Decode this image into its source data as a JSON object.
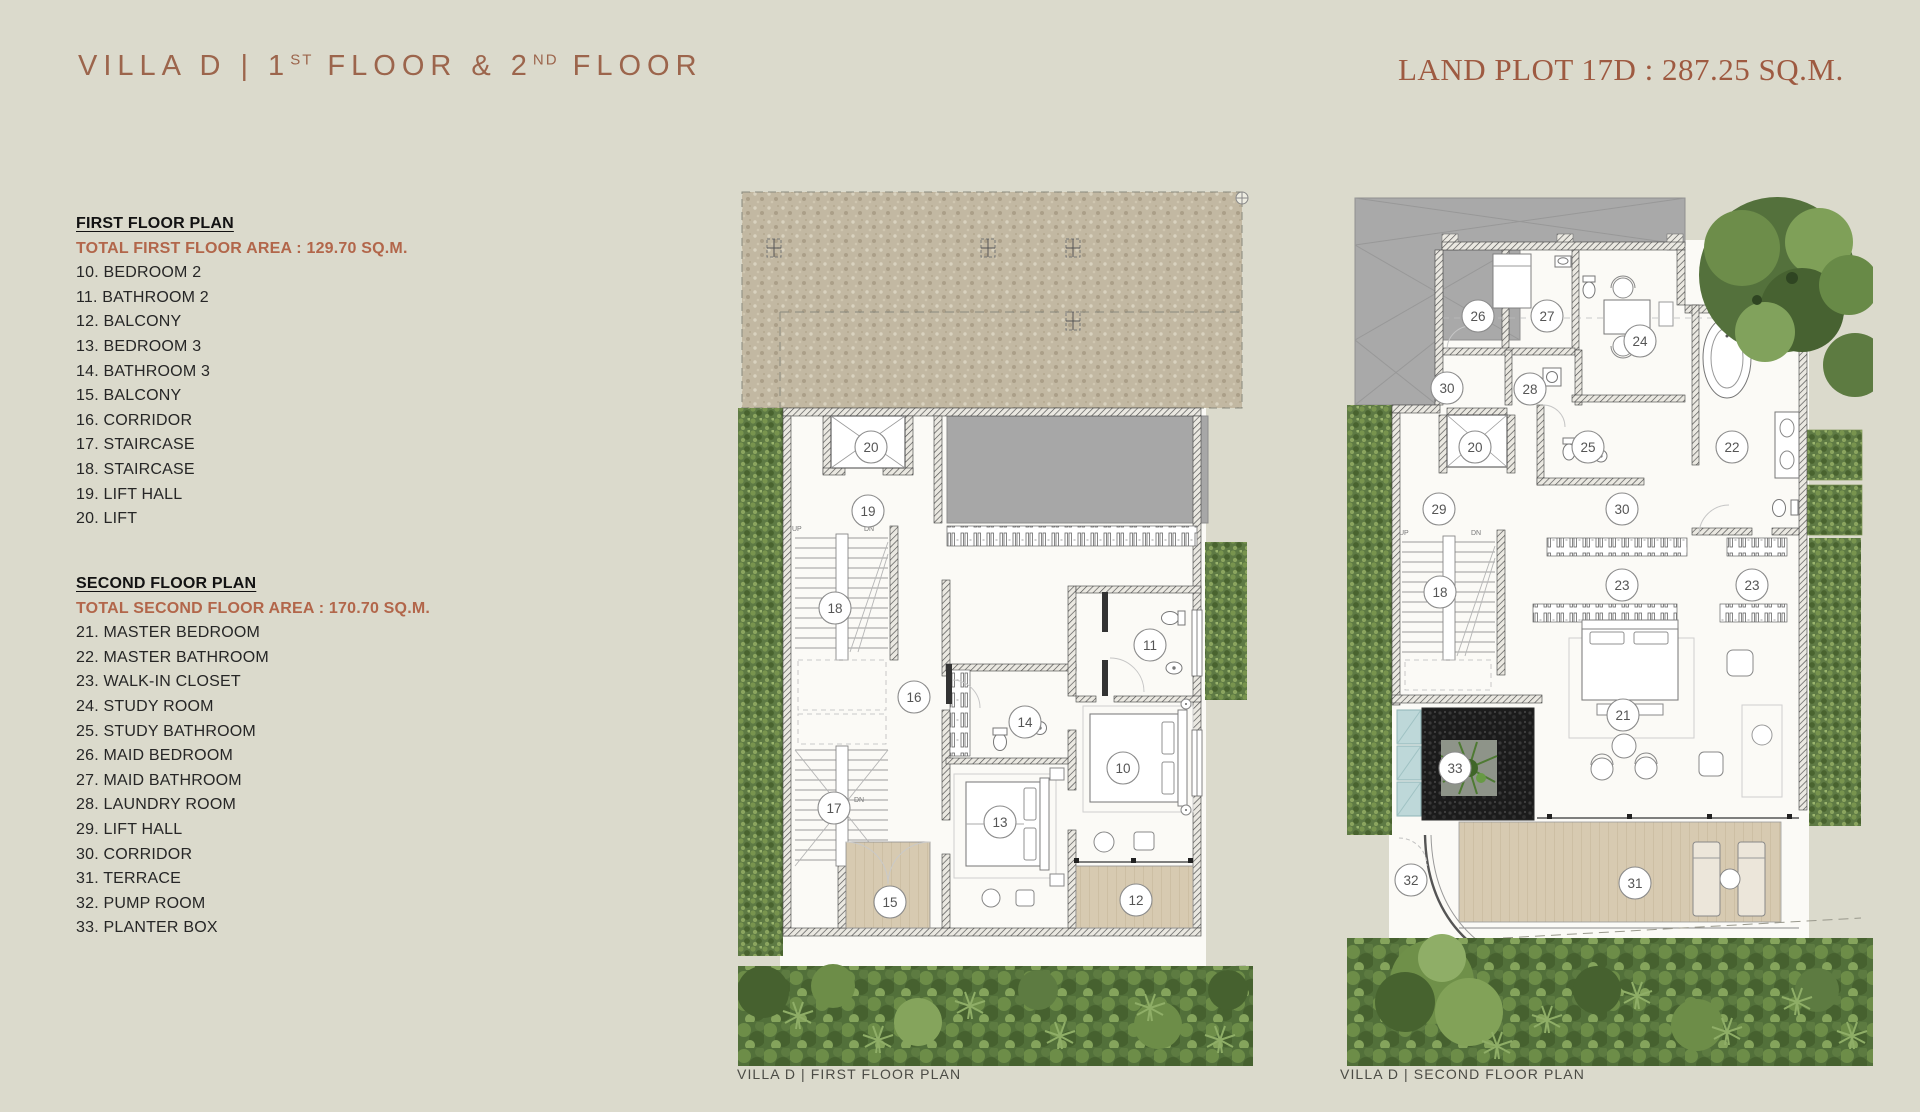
{
  "header": {
    "villa": {
      "p1": "VILLA D | 1",
      "sup1": "ST",
      "p2": " FLOOR & 2",
      "sup2": "ND",
      "p3": " FLOOR"
    },
    "land_plot": "LAND PLOT 17D : 287.25 SQ.M."
  },
  "legend_first": {
    "heading": "FIRST FLOOR PLAN",
    "area": "TOTAL FIRST FLOOR AREA : 129.70 SQ.M.",
    "items": [
      "10. BEDROOM 2",
      "11. BATHROOM 2",
      "12. BALCONY",
      "13. BEDROOM 3",
      "14. BATHROOM 3",
      "15. BALCONY",
      "16. CORRIDOR",
      "17. STAIRCASE",
      "18. STAIRCASE",
      "19. LIFT HALL",
      "20. LIFT"
    ]
  },
  "legend_second": {
    "heading": "SECOND FLOOR PLAN",
    "area": "TOTAL SECOND FLOOR AREA : 170.70 SQ.M.",
    "items": [
      "21. MASTER BEDROOM",
      "22. MASTER BATHROOM",
      "23. WALK-IN CLOSET",
      "24. STUDY ROOM",
      "25. STUDY BATHROOM",
      "26. MAID BEDROOM",
      "27. MAID BATHROOM",
      "28. LAUNDRY ROOM",
      "29. LIFT HALL",
      "30. CORRIDOR",
      "31. TERRACE",
      "32. PUMP ROOM",
      "33. PLANTER BOX"
    ]
  },
  "plans": {
    "first": {
      "caption": "VILLA D | FIRST FLOOR PLAN",
      "labels": [
        "20",
        "19",
        "18",
        "16",
        "17",
        "14",
        "13",
        "15",
        "11",
        "10",
        "12"
      ]
    },
    "second": {
      "caption": "VILLA D | SECOND FLOOR PLAN",
      "labels": [
        "26",
        "27",
        "24",
        "30",
        "28",
        "20",
        "25",
        "22",
        "29",
        "30",
        "18",
        "23",
        "23",
        "21",
        "33",
        "32",
        "31"
      ]
    }
  },
  "stairs": {
    "up": "UP",
    "dn": "DN"
  },
  "colors": {
    "background": "#dbdacc",
    "title_sans": "#9c654c",
    "title_serif": "#9e5a41",
    "legend_area": "#b2664a",
    "caption": "#4b4b45",
    "gravel": "#c2b8a2",
    "roof_gray": "#a7a7a7",
    "hedge_green": "#5e7a44",
    "deck_wood": "#d7cab1",
    "pebble_black": "#1b1b1b",
    "glass_blue": "#bed8d9",
    "room_white": "#fbfaf6"
  }
}
